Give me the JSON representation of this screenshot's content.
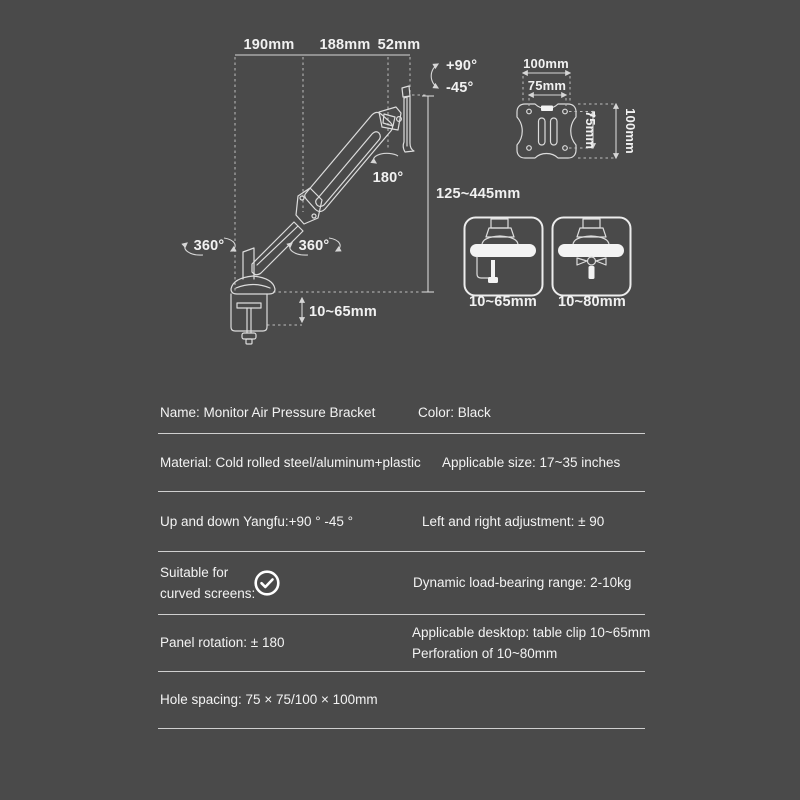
{
  "colors": {
    "background": "#4a4a4a",
    "diagram_line": "#dcdcdc",
    "divider_line": "#cfcfcf",
    "text": "#f3f3f3"
  },
  "diagram": {
    "top_widths": [
      "190mm",
      "188mm",
      "52mm"
    ],
    "tilt": {
      "up": "+90°",
      "down": "-45°"
    },
    "panel_rotation": "180°",
    "swivel_left": "360°",
    "swivel_right": "360°",
    "height_range": "125~445mm",
    "clamp_thickness": "10~65mm",
    "vesa": {
      "top_width": "100mm",
      "inner_width": "75mm",
      "inner_height": "75mm",
      "side_height": "100mm"
    },
    "mounts": [
      {
        "label": "10~65mm"
      },
      {
        "label": "10~80mm"
      }
    ]
  },
  "specs": {
    "rows": [
      {
        "left": "Name: Monitor Air Pressure Bracket",
        "right": "Color: Black"
      },
      {
        "left": "Material: Cold rolled steel/aluminum+plastic",
        "right": "Applicable size: 17~35 inches"
      },
      {
        "left": "Up and down Yangfu:+90 ° -45 °",
        "right": "Left and right adjustment: ± 90"
      },
      {
        "left_line1": "Suitable for",
        "left_line2": "curved screens:",
        "right": "Dynamic load-bearing range: 2-10kg"
      },
      {
        "left": "Panel rotation: ± 180",
        "right_line1": "Applicable desktop: table clip 10~65mm",
        "right_line2": "Perforation of 10~80mm"
      },
      {
        "left": "Hole spacing: 75 × 75/100 × 100mm"
      }
    ]
  }
}
